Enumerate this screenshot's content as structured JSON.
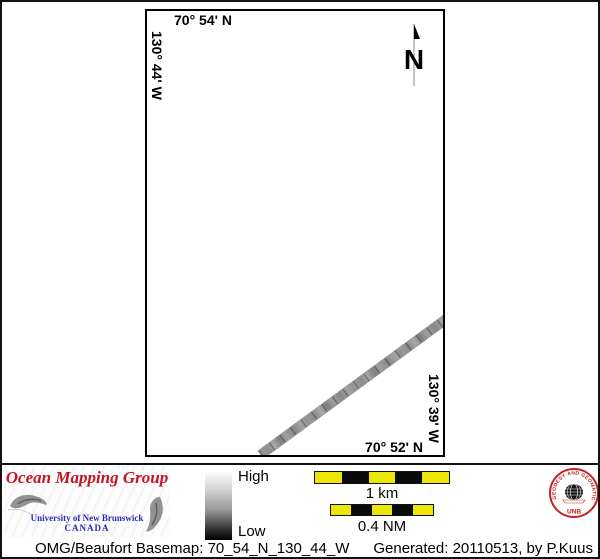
{
  "map": {
    "coord_top": "70° 54' N",
    "coord_left": "130° 44' W",
    "coord_right": "130° 39' W",
    "coord_bottom": "70° 52' N",
    "north_label": "N"
  },
  "legend": {
    "high": "High",
    "low": "Low"
  },
  "scalebars": {
    "km_label": "1 km",
    "nm_label": "0.4 NM"
  },
  "logo": {
    "title": "Ocean Mapping Group",
    "university": "University of New Brunswick",
    "country": "CANADA"
  },
  "seal": {
    "ring_text": "GEODESY AND GEOMATICS ENGINEERING",
    "bottom_text": "UNB"
  },
  "footer": {
    "left": "OMG/Beaufort Basemap: 70_54_N_130_44_W",
    "right": "Generated: 20110513, by P.Kuus"
  },
  "colors": {
    "logo_red": "#c41425",
    "logo_blue": "#2a2ab8",
    "seal_red": "#c4231f",
    "scalebar_yellow": "#ece607",
    "track_gray": "#949494",
    "border_black": "#111111"
  }
}
